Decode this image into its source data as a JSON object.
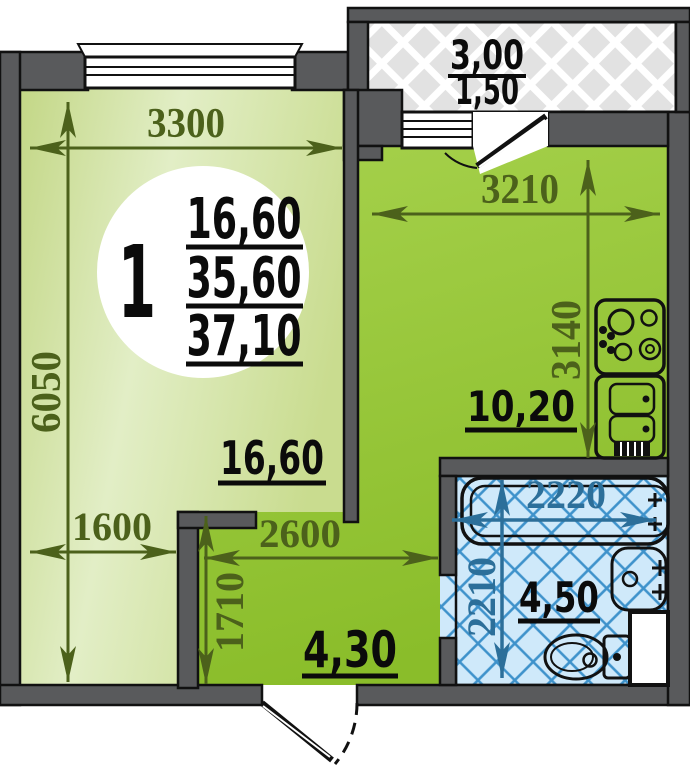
{
  "unit_badge": {
    "rooms": "1",
    "areas": {
      "living": "16,60",
      "total": "35,60",
      "total_with_balcony": "37,10"
    }
  },
  "living_room": {
    "area": "16,60",
    "width": "3300",
    "height": "6050",
    "nook_width": "1600"
  },
  "kitchen": {
    "area": "10,20",
    "width": "3210",
    "height": "3140"
  },
  "hall": {
    "area": "4,30",
    "width": "2600",
    "depth": "1710"
  },
  "bathroom": {
    "area": "4,50",
    "width": "2220",
    "height": "2210"
  },
  "balcony": {
    "area_total": "3,00",
    "area_counted": "1,50"
  },
  "colors": {
    "wall": "#595a5c",
    "outline": "#111111",
    "living_fill_light": "#e2eec6",
    "living_fill_dark": "#c3d786",
    "kitchen_fill_top": "#a6d14c",
    "kitchen_fill_bottom": "#8abd2a",
    "bathroom_tile_bg": "#cfe9fa",
    "bathroom_tile_line": "#3e92cb",
    "balcony_hatch_bg": "#e2e2e2",
    "balcony_hatch_line": "#ffffff",
    "dimension_green": "#4c611b",
    "dimension_blue": "#2c6f9a",
    "label_black": "#0b0b0b"
  }
}
